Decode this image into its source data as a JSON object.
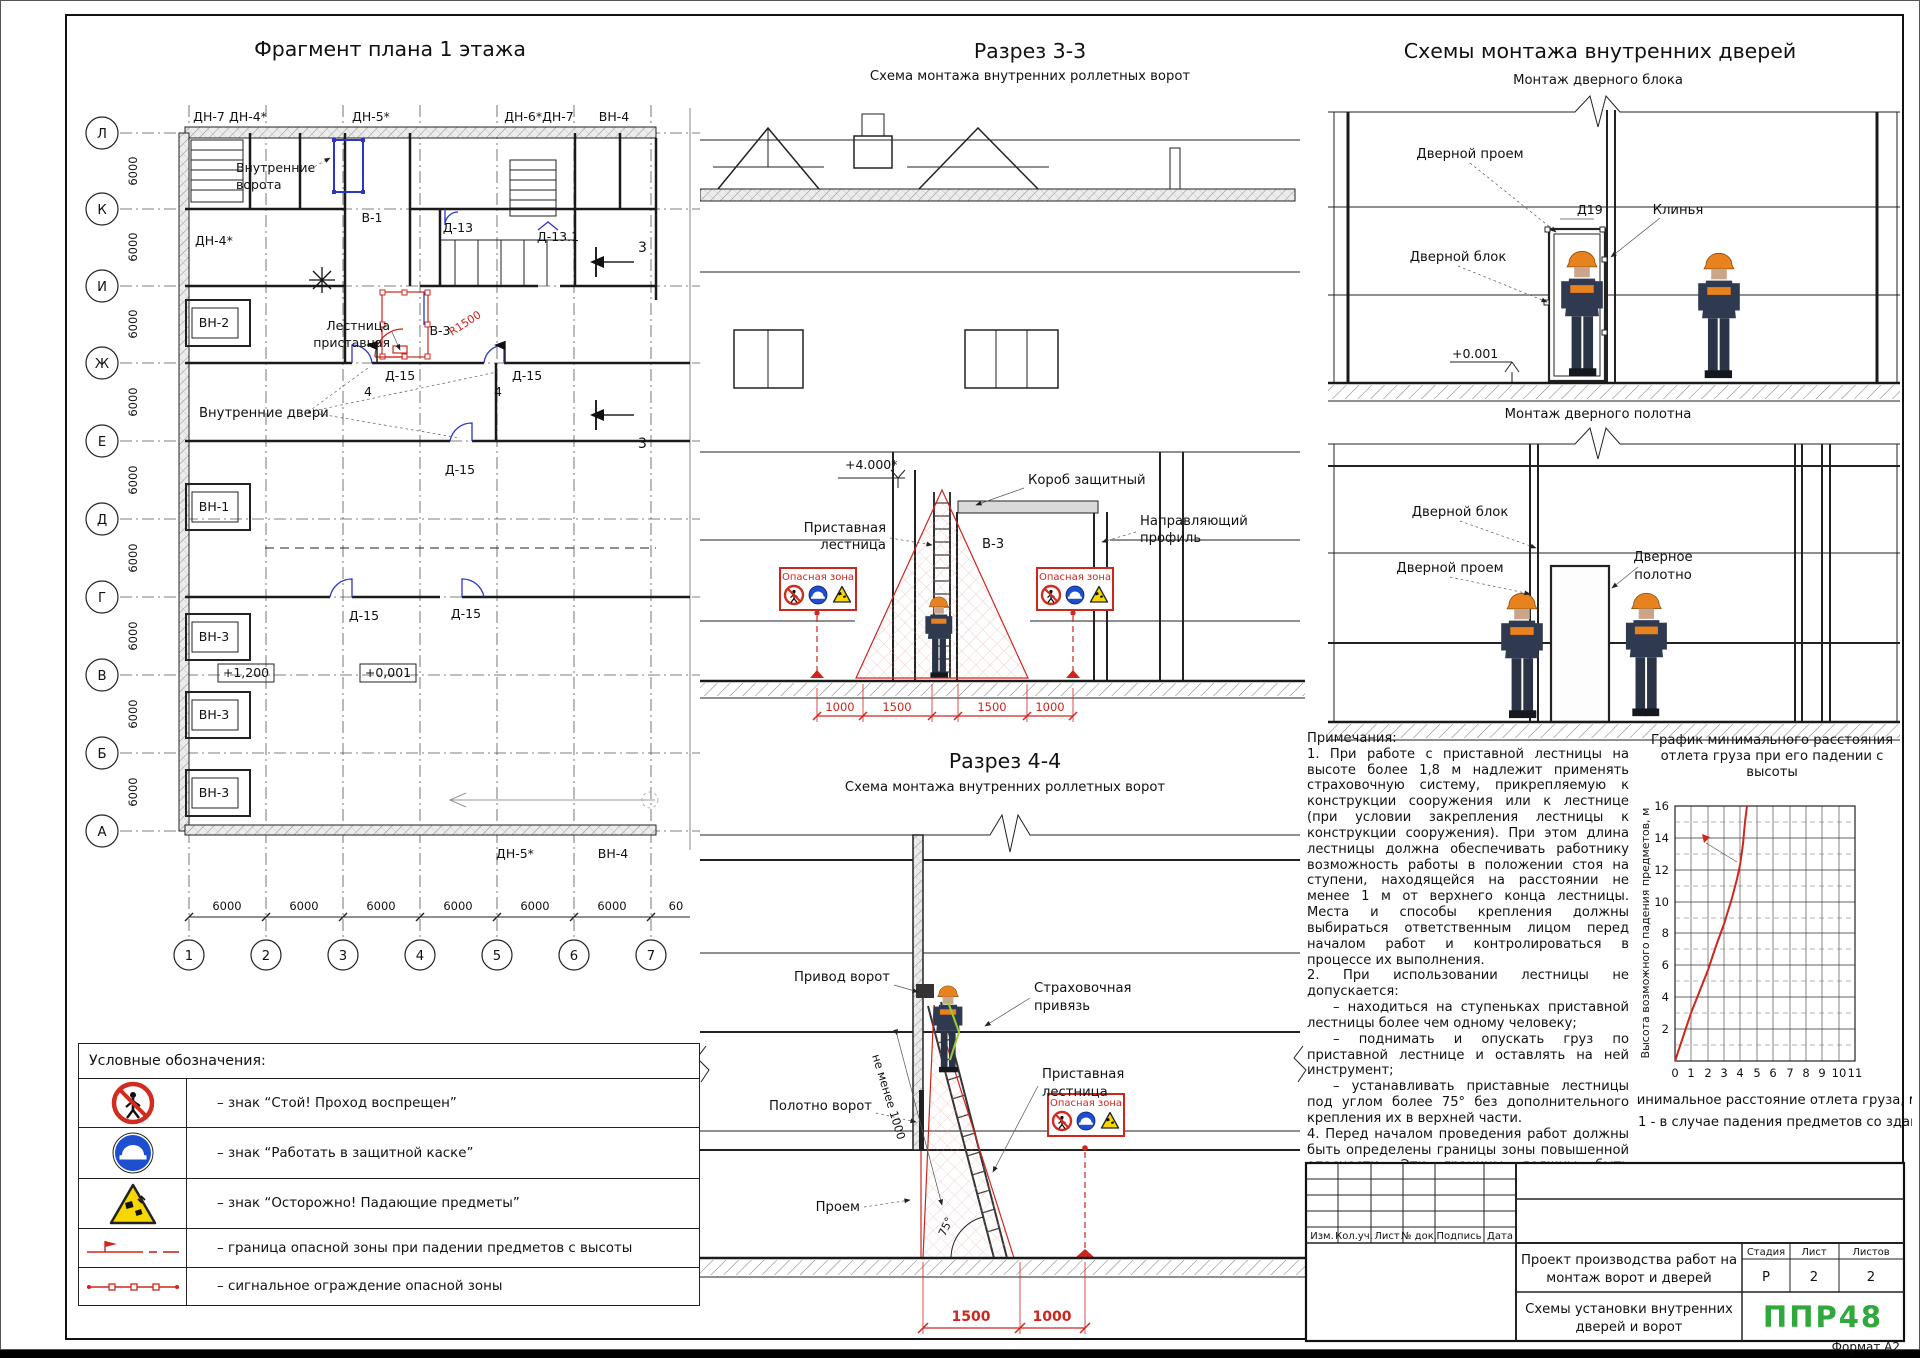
{
  "sheet": {
    "format": "Формат А2"
  },
  "plan": {
    "title": "Фрагмент плана 1 этажа",
    "row_axes": [
      "Л",
      "К",
      "И",
      "Ж",
      "Е",
      "Д",
      "Г",
      "В",
      "Б",
      "А"
    ],
    "col_axes": [
      "1",
      "2",
      "3",
      "4",
      "5",
      "6",
      "7"
    ],
    "bay_dim": "6000",
    "bay_dim_cut": "60",
    "top_marks": [
      "ДН-7",
      "ДН-4*",
      "ДН-5*",
      "ДН-6*ДН-7",
      "ВН-4"
    ],
    "bottom_marks": [
      "ДН-5*",
      "ВН-4"
    ],
    "gate_boxes": [
      "ВН-2",
      "ВН-1",
      "ВН-3",
      "ВН-3",
      "ВН-3"
    ],
    "labels": {
      "inner_gates_1": "Внутренние",
      "inner_gates_2": "ворота",
      "v1": "В-1",
      "d13": "Д-13",
      "d131": "Д-13.1",
      "dn4": "ДН-4*",
      "ladder_1": "Лестница",
      "ladder_2": "приставная",
      "v3": "В-3",
      "r1500": "R1500",
      "d15": "Д-15",
      "sec4": "4",
      "sec3": "3",
      "inner_doors": "Внутренние двери",
      "lvl_high": "+1,200",
      "lvl_zero": "+0,001"
    }
  },
  "section3": {
    "title": "Разрез 3-3",
    "subtitle": "Схема монтажа внутренних роллетных ворот",
    "level": "+4.000*",
    "korob": "Короб защитный",
    "guide_1": "Направляющий",
    "guide_2": "профиль",
    "ladder_1": "Приставная",
    "ladder_2": "лестница",
    "v3": "В-3",
    "dims": [
      "1000",
      "1500",
      "1500",
      "1000"
    ]
  },
  "doors": {
    "title": "Схемы монтажа внутренних дверей",
    "scheme1_title": "Монтаж дверного блока",
    "scheme2_title": "Монтаж дверного полотна",
    "proem": "Дверной проем",
    "d19": "Д19",
    "klinya": "Клинья",
    "block": "Дверной блок",
    "level": "+0.001",
    "leaf_1": "Дверное",
    "leaf_2": "полотно"
  },
  "section4": {
    "title": "Разрез 4-4",
    "subtitle": "Схема монтажа внутренних роллетных ворот",
    "privod": "Привод ворот",
    "strah_1": "Страховочная",
    "strah_2": "привязь",
    "ladder_1": "Приставная",
    "ladder_2": "лестница",
    "ne_menee": "не менее 1000",
    "polotno": "Полотно ворот",
    "proem": "Проем",
    "angle": "75°",
    "dims": [
      "1500",
      "1000"
    ]
  },
  "danger_sign": {
    "title": "Опасная зона"
  },
  "legend": {
    "title": "Условные обозначения:",
    "rows": [
      "– знак “Стой! Проход воспрещен”",
      "– знак “Работать в защитной каске”",
      "– знак “Осторожно! Падающие предметы”",
      "– граница опасной зоны при падении предметов с высоты",
      "– сигнальное ограждение опасной зоны"
    ]
  },
  "notes": {
    "title": "Примечания:",
    "p1": "1. При работе с приставной лестницы на высоте более 1,8 м надлежит применять страховочную систему, прикрепляемую к конструкции сооружения или к лестнице (при условии закрепления лестницы к конструкции сооружения). При этом длина лестницы должна обеспечивать работнику возможность работы в положении стоя на ступени, находящейся на расстоянии не менее 1 м от верхнего конца лестницы. Места и способы крепления должны выбираться ответственным лицом перед началом работ и контролироваться в процессе их выполнения.",
    "p2": "2. При использовании лестницы не допускается:",
    "b1": "– находиться на ступеньках приставной лестницы более чем одному человеку;",
    "b2": "– поднимать и опускать груз по приставной лестнице и оставлять на ней инструмент;",
    "b3": "– устанавливать приставные лестницы под углом более 75° без дополнительного крепления их в верхней части.",
    "p4": "4. Перед началом проведения работ должны быть определены границы зоны повышенной опасности. Эти границы должны быть обозначены временными ограждающими устройствами и помечены информационными знаками безопасности."
  },
  "chart": {
    "title_1": "График минимального расстояния",
    "title_2": "отлета груза при его падении с",
    "title_3": "высоты",
    "ylabel": "Высота возможного падения предметов, м",
    "xlabel": "Минимальное расстояние отлета груза, м",
    "caption": "1 - в случае падения предметов со здания",
    "x_ticks": [
      "0",
      "1",
      "2",
      "3",
      "4",
      "5",
      "6",
      "7",
      "8",
      "9",
      "10",
      "11"
    ],
    "y_ticks": [
      "2",
      "4",
      "6",
      "8",
      "10",
      "12",
      "14",
      "16"
    ]
  },
  "chart_data": {
    "type": "line",
    "title": "График минимального расстояния отлета груза при его падении с высоты",
    "xlabel": "Минимальное расстояние отлета груза, м",
    "ylabel": "Высота возможного падения предметов, м",
    "xlim": [
      0,
      11
    ],
    "ylim": [
      0,
      16
    ],
    "grid": true,
    "series": [
      {
        "name": "1 - в случае падения предметов со здания",
        "x": [
          0,
          1,
          2,
          2.5,
          3,
          3.5,
          3.8,
          4,
          4.15,
          4.3,
          4.4
        ],
        "y": [
          0,
          3,
          5.7,
          7.2,
          8.6,
          10.2,
          11.4,
          12.3,
          13.6,
          15,
          16
        ]
      }
    ]
  },
  "titleblock": {
    "rev_headers": [
      "Изм.",
      "Кол.уч.",
      "Лист",
      "№ док.",
      "Подпись",
      "Дата"
    ],
    "project_1": "Проект производства работ на",
    "project_2": "монтаж ворот и дверей",
    "sheet_name_1": "Схемы установки внутренних",
    "sheet_name_2": "дверей и ворот",
    "stage_h": "Стадия",
    "sheet_h": "Лист",
    "sheets_h": "Листов",
    "stage": "Р",
    "sheet": "2",
    "sheets": "2",
    "logo": "ППР48"
  },
  "colors": {
    "red": "#cf251d",
    "blue": "#2b36c8",
    "green": "#2fa83c"
  }
}
